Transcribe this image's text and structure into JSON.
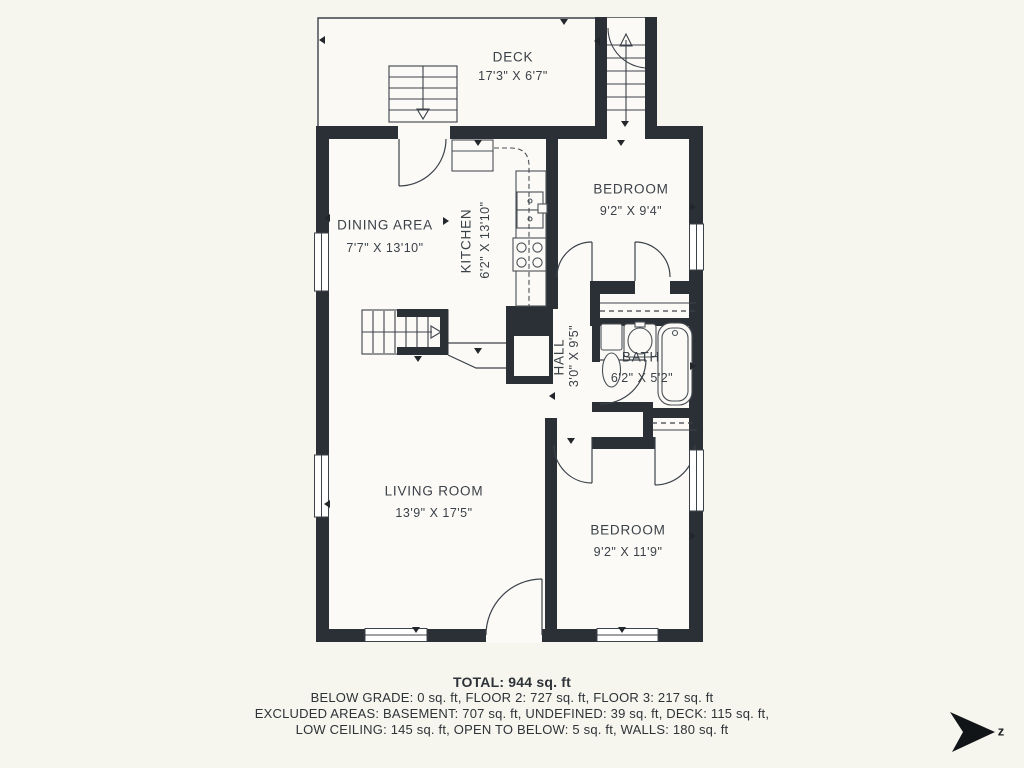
{
  "plan": {
    "rooms": {
      "deck": {
        "name": "DECK",
        "dims": "17'3\" X 6'7\""
      },
      "bedroom1": {
        "name": "BEDROOM",
        "dims": "9'2\" X 9'4\""
      },
      "dining": {
        "name": "DINING AREA",
        "dims": "7'7\" X 13'10\""
      },
      "kitchen": {
        "name": "KITCHEN",
        "dims": "6'2\" X 13'10\""
      },
      "hall": {
        "name": "HALL",
        "dims": "3'0\" X 9'5\""
      },
      "bath": {
        "name": "BATH",
        "dims": "6'2\" X 5'2\""
      },
      "living": {
        "name": "LIVING ROOM",
        "dims": "13'9\" X 17'5\""
      },
      "bedroom2": {
        "name": "BEDROOM",
        "dims": "9'2\" X 11'9\""
      }
    },
    "summary": {
      "total": "TOTAL: 944 sq. ft",
      "line1": "BELOW GRADE: 0 sq. ft, FLOOR 2: 727 sq. ft, FLOOR 3: 217 sq. ft",
      "line2": "EXCLUDED AREAS: BASEMENT: 707 sq. ft, UNDEFINED: 39 sq. ft, DECK: 115 sq. ft,",
      "line3": "LOW CEILING: 145 sq. ft, OPEN TO BELOW: 5 sq. ft, WALLS: 180 sq. ft"
    },
    "compass": {
      "label": "z"
    },
    "colors": {
      "wall": "#2b3036",
      "line": "#3c424a",
      "background": "#f6f5ee",
      "floor": "#fbfaf6"
    }
  }
}
